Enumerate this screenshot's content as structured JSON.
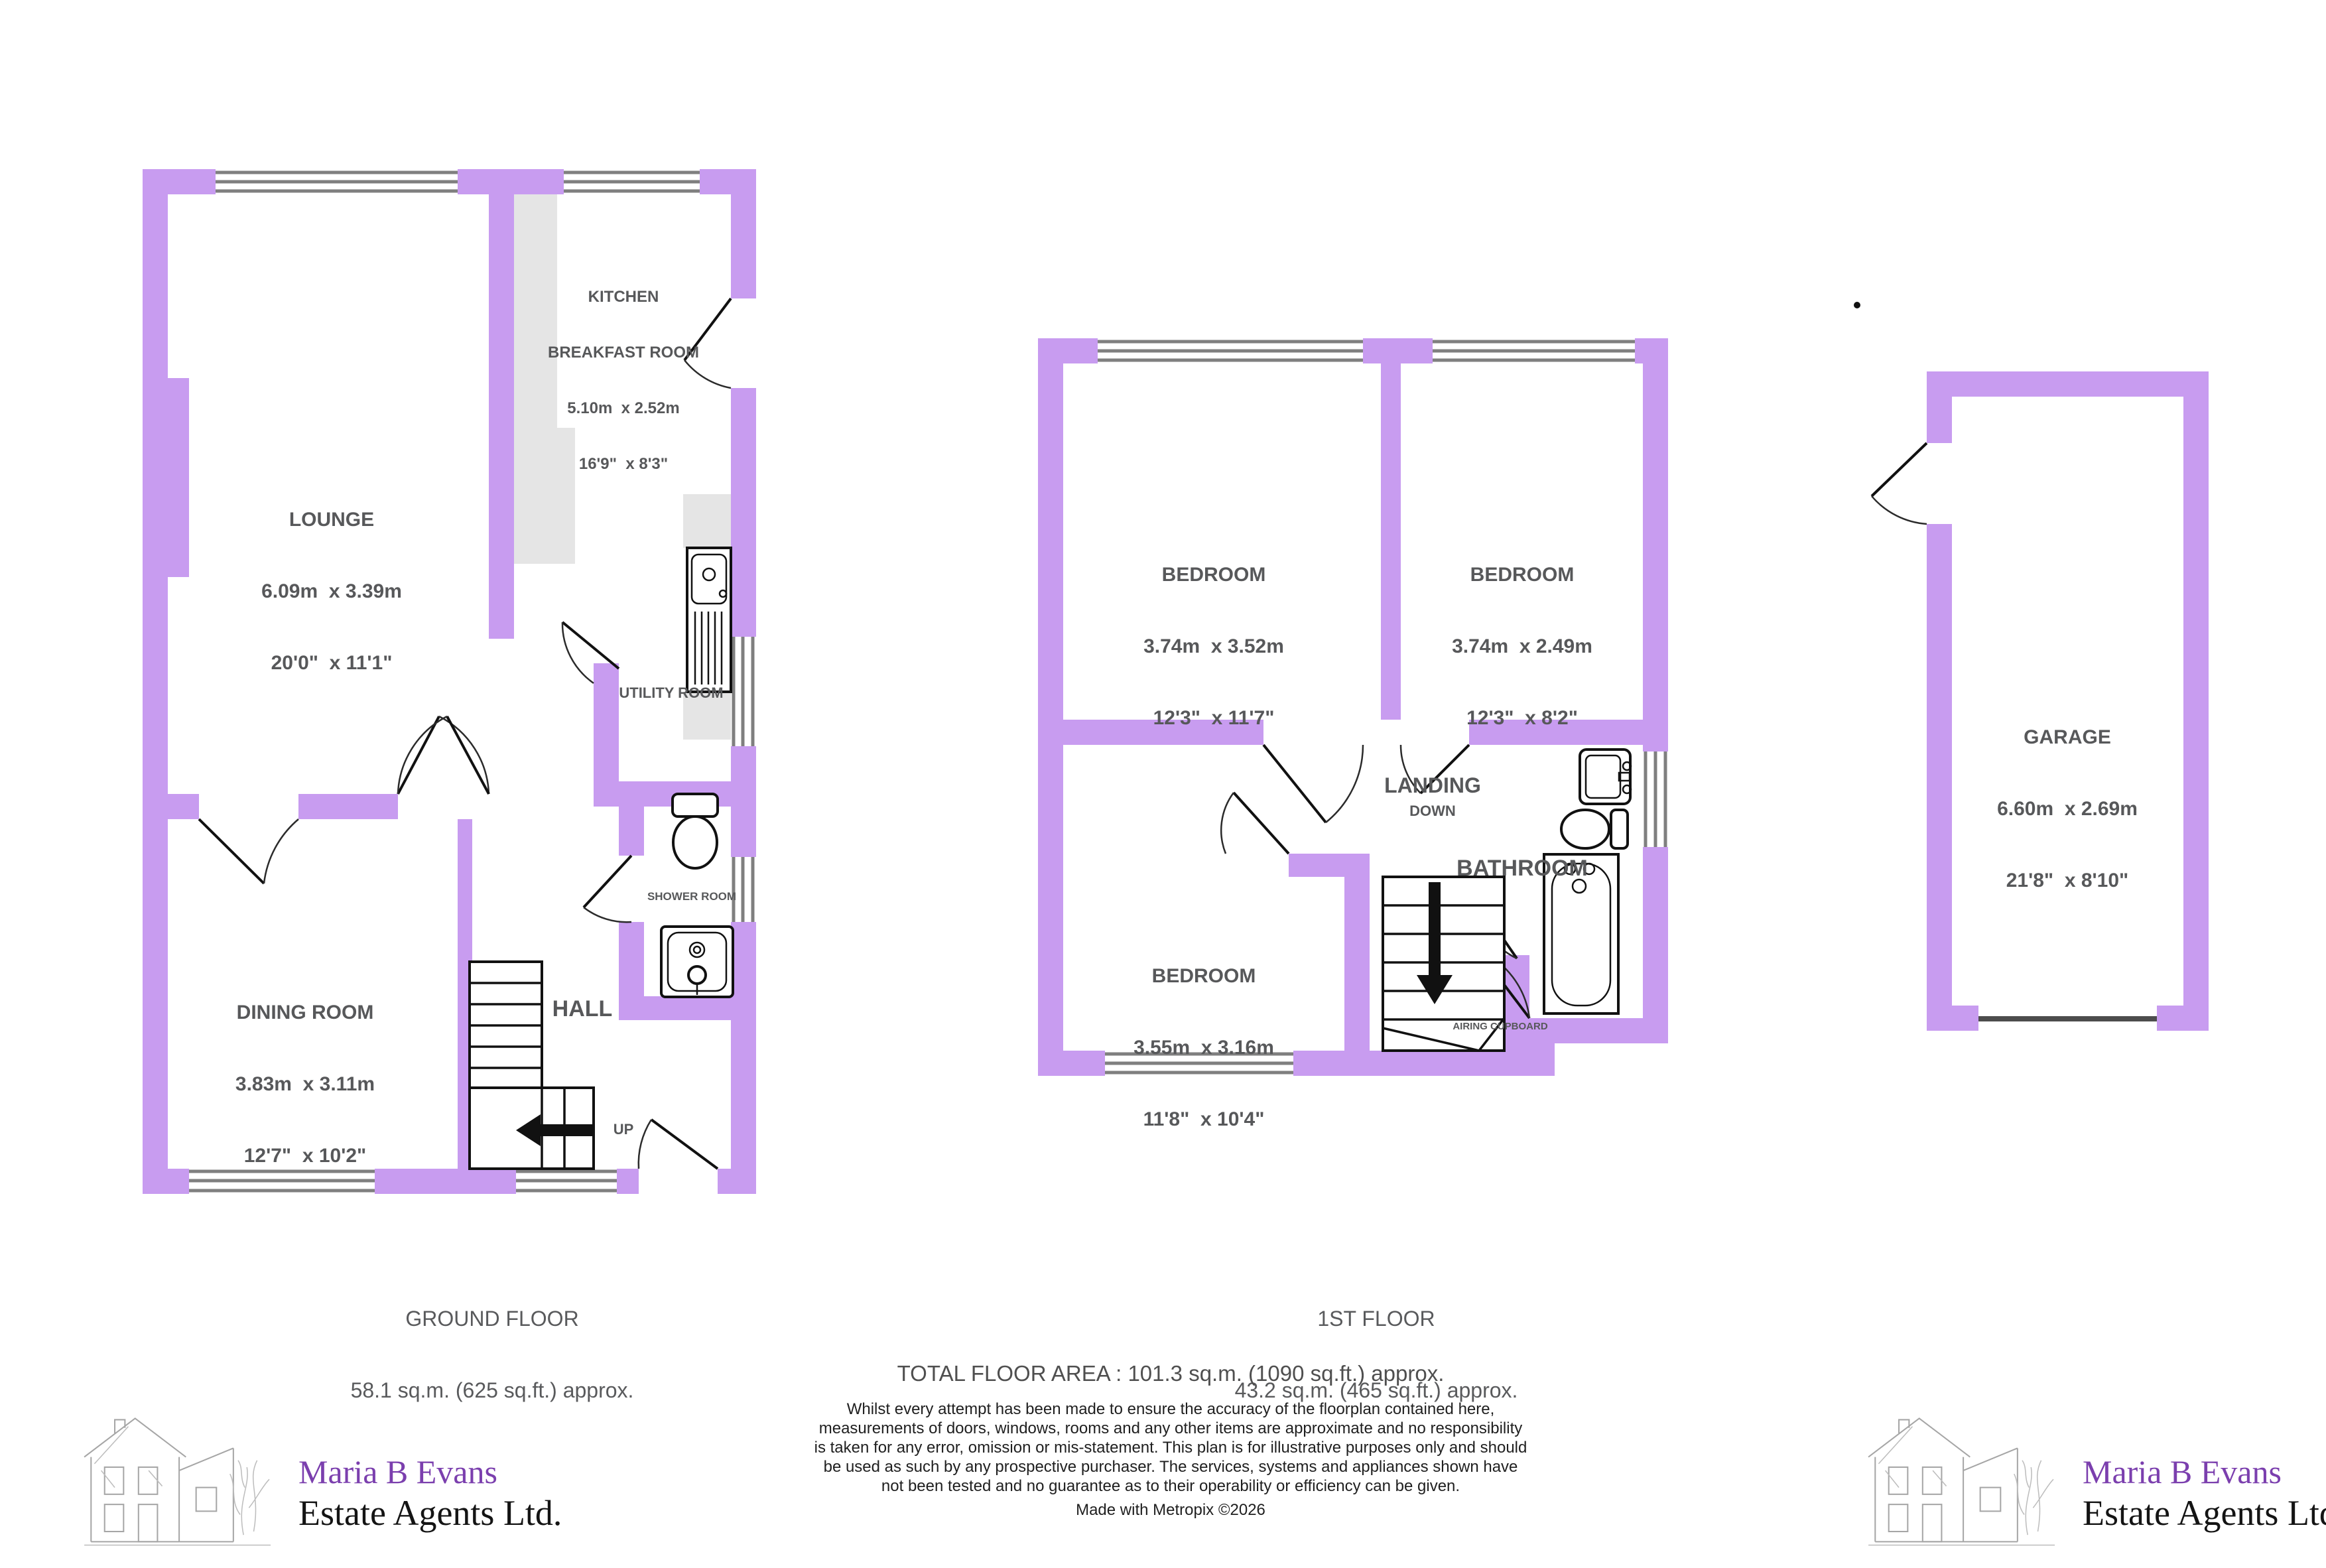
{
  "ground_floor": {
    "caption_line1": "GROUND FLOOR",
    "caption_line2": "58.1 sq.m. (625 sq.ft.) approx.",
    "rooms": {
      "lounge": {
        "name": "LOUNGE",
        "metric": "6.09m  x 3.39m",
        "imperial": "20'0\"  x 11'1\""
      },
      "kitchen": {
        "name_line1": "KITCHEN",
        "name_line2": "BREAKFAST ROOM",
        "metric": "5.10m  x 2.52m",
        "imperial": "16'9\"  x 8'3\""
      },
      "dining": {
        "name": "DINING ROOM",
        "metric": "3.83m  x 3.11m",
        "imperial": "12'7\"  x 10'2\""
      },
      "hall": {
        "name": "HALL"
      },
      "utility": {
        "name": "UTILITY ROOM"
      },
      "shower": {
        "name": "SHOWER ROOM"
      },
      "up_label": "UP"
    }
  },
  "first_floor": {
    "caption_line1": "1ST FLOOR",
    "caption_line2": "43.2 sq.m. (465 sq.ft.) approx.",
    "rooms": {
      "bedroom1": {
        "name": "BEDROOM",
        "metric": "3.74m  x 3.52m",
        "imperial": "12'3\"  x 11'7\""
      },
      "bedroom2": {
        "name": "BEDROOM",
        "metric": "3.74m  x 2.49m",
        "imperial": "12'3\"  x 8'2\""
      },
      "bedroom3": {
        "name": "BEDROOM",
        "metric": "3.55m  x 3.16m",
        "imperial": "11'8\"  x 10'4\""
      },
      "landing": {
        "name": "LANDING",
        "down_label": "DOWN"
      },
      "bathroom": {
        "name": "BATHROOM"
      },
      "airing": {
        "name": "AIRING CUPBOARD"
      }
    }
  },
  "garage": {
    "name": "GARAGE",
    "metric": "6.60m  x 2.69m",
    "imperial": "21'8\"  x 8'10\""
  },
  "footer": {
    "total_area": "TOTAL FLOOR AREA : 101.3 sq.m. (1090 sq.ft.) approx.",
    "disclaimer": "Whilst every attempt has been made to ensure the accuracy of the floorplan contained here, measurements of doors, windows, rooms and any other items are approximate and no responsibility is taken for any error, omission or mis-statement. This plan is for illustrative purposes only and should be used as such by any prospective purchaser. The services, systems and appliances shown have not been tested and no guarantee as to their operability or efficiency can be given.",
    "credit": "Made with Metropix ©2026"
  },
  "branding": {
    "name": "Maria B Evans",
    "subtitle": "Estate Agents Ltd."
  },
  "colors": {
    "wall": "#c89cf0",
    "label_gray": "#57585a",
    "brand_purple": "#7b3fae",
    "counter_gray": "#e5e5e5"
  }
}
